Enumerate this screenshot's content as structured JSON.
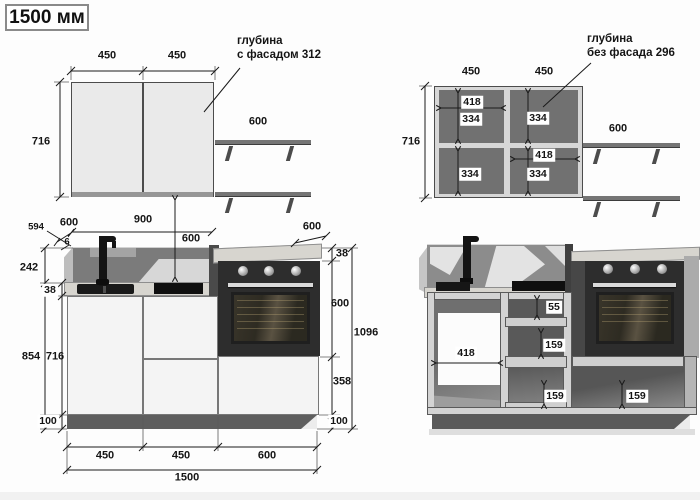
{
  "title": "1500 мм",
  "wall_front": {
    "w1": "450",
    "w2": "450",
    "h": "716",
    "shelf": "600",
    "note1": "глубина",
    "note2": "с фасадом 312"
  },
  "wall_carcass": {
    "w1": "450",
    "w2": "450",
    "h": "716",
    "shelf": "600",
    "note1": "глубина",
    "note2": "без фасада 296",
    "iw1": "418",
    "ih1": "334",
    "ih2": "334",
    "iw2": "418",
    "ih3": "334",
    "ih4": "334"
  },
  "base_front": {
    "depth_carcass": "594",
    "depth_left": "600",
    "gap": "6",
    "span": "900",
    "apron": "600",
    "depth_right": "600",
    "counter_r": "38",
    "oven": "600",
    "below_oven": "358",
    "plinth_r": "100",
    "total_h": "1096",
    "apron_counter": "242",
    "counter_l": "38",
    "total_l": "854",
    "carcass_h": "716",
    "plinth_l": "100",
    "b1": "450",
    "b2": "450",
    "b3": "600",
    "total_w": "1500"
  },
  "base_carcass": {
    "iw": "418",
    "top": "55",
    "mid": "159",
    "bot": "159",
    "right": "159"
  }
}
